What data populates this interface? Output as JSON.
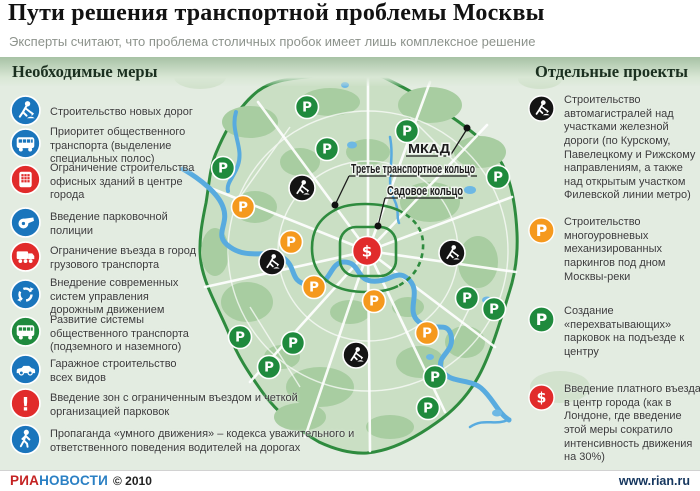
{
  "title": "Пути решения транспортной проблемы Москвы",
  "subtitle": "Эксперты считают, что проблема столичных пробок имеет лишь комплексное решение",
  "left_panel": {
    "header": "Необходимые меры",
    "items": [
      {
        "icon": "roadworks-icon",
        "color": "#1a75bc",
        "text": "Строительство новых дорог"
      },
      {
        "icon": "bus-icon",
        "color": "#1a75bc",
        "text": "Приоритет общественного транспорта (выделение специальных полос)"
      },
      {
        "icon": "building-icon",
        "color": "#e12b2b",
        "text": "Ограничение строительства офисных зданий в центре города"
      },
      {
        "icon": "whistle-icon",
        "color": "#1a75bc",
        "text": "Введение парковочной полиции"
      },
      {
        "icon": "truck-icon",
        "color": "#e12b2b",
        "text": "Ограничение въезда в город грузового транспорта"
      },
      {
        "icon": "arrows-icon",
        "color": "#1a75bc",
        "text": "Внедрение современных систем управления дорожным движением"
      },
      {
        "icon": "bus-icon",
        "color": "#1f8a3d",
        "text": "Развитие системы общественного транспорта (подземного и наземного)"
      },
      {
        "icon": "car-icon",
        "color": "#1a75bc",
        "text": "Гаражное строительство всех видов"
      },
      {
        "icon": "exclaim-icon",
        "color": "#e12b2b",
        "text": "Введение зон с ограниченным въездом и четкой организацией парковок"
      },
      {
        "icon": "pedestrian-icon",
        "color": "#1a75bc",
        "text": "Пропаганда «умного движения» – кодекса уважительного и ответственного поведения водителей на дорогах"
      }
    ]
  },
  "right_panel": {
    "header": "Отдельные проекты",
    "items": [
      {
        "icon": "roadworks-icon",
        "color": "#141414",
        "text": "Строительство автомагистралей над участками железной дороги (по Курскому, Павелецкому и Рижскому направлениям, а также над открытым участком Филевской линии метро)"
      },
      {
        "icon": "parking-icon",
        "color": "#f5991d",
        "text": "Строительство многоуровневых механизированных паркингов под дном Москвы-реки"
      },
      {
        "icon": "parking-icon",
        "color": "#1f8a3d",
        "text": "Создание «перехватывающих» парковок на подъезде к центру"
      },
      {
        "icon": "toll-icon",
        "color": "#e12b2b",
        "text": "Введение платного въезда в центр города (как в Лондоне, где введение этой меры сократило интенсивность движения на 30%)"
      }
    ]
  },
  "map": {
    "labels": {
      "mkad": "МКАД",
      "ttk": "Третье транспортное кольцо",
      "sadovoe": "Садовое кольцо"
    },
    "markers": [
      {
        "type": "parking-green",
        "x": 307,
        "y": 107
      },
      {
        "type": "parking-green",
        "x": 327,
        "y": 149
      },
      {
        "type": "parking-green",
        "x": 407,
        "y": 131
      },
      {
        "type": "parking-green",
        "x": 223,
        "y": 168
      },
      {
        "type": "parking-green",
        "x": 498,
        "y": 177
      },
      {
        "type": "parking-green",
        "x": 467,
        "y": 298
      },
      {
        "type": "parking-green",
        "x": 494,
        "y": 309
      },
      {
        "type": "parking-green",
        "x": 240,
        "y": 337
      },
      {
        "type": "parking-green",
        "x": 293,
        "y": 343
      },
      {
        "type": "parking-green",
        "x": 269,
        "y": 367
      },
      {
        "type": "parking-green",
        "x": 435,
        "y": 377
      },
      {
        "type": "parking-green",
        "x": 428,
        "y": 408
      },
      {
        "type": "parking-orange",
        "x": 243,
        "y": 207
      },
      {
        "type": "parking-orange",
        "x": 291,
        "y": 242
      },
      {
        "type": "parking-orange",
        "x": 314,
        "y": 287
      },
      {
        "type": "parking-orange",
        "x": 374,
        "y": 301
      },
      {
        "type": "parking-orange",
        "x": 427,
        "y": 333
      },
      {
        "type": "roadworks",
        "x": 302,
        "y": 188
      },
      {
        "type": "roadworks",
        "x": 272,
        "y": 262
      },
      {
        "type": "roadworks",
        "x": 452,
        "y": 253
      },
      {
        "type": "roadworks",
        "x": 356,
        "y": 355
      },
      {
        "type": "toll",
        "x": 367,
        "y": 251
      }
    ]
  },
  "footer": {
    "brand_red": "РИА",
    "brand_blue": "НОВОСТИ",
    "copyright": "© 2010",
    "url": "www.rian.ru"
  },
  "colors": {
    "icon_blue": "#1a75bc",
    "icon_red": "#e12b2b",
    "icon_green": "#1f8a3d",
    "icon_orange": "#f5991d",
    "icon_black": "#141414",
    "ring_green": "#2e8b3e",
    "water_blue": "#58abdf",
    "brand_red": "#c42222",
    "brand_blue": "#2b80c4"
  }
}
